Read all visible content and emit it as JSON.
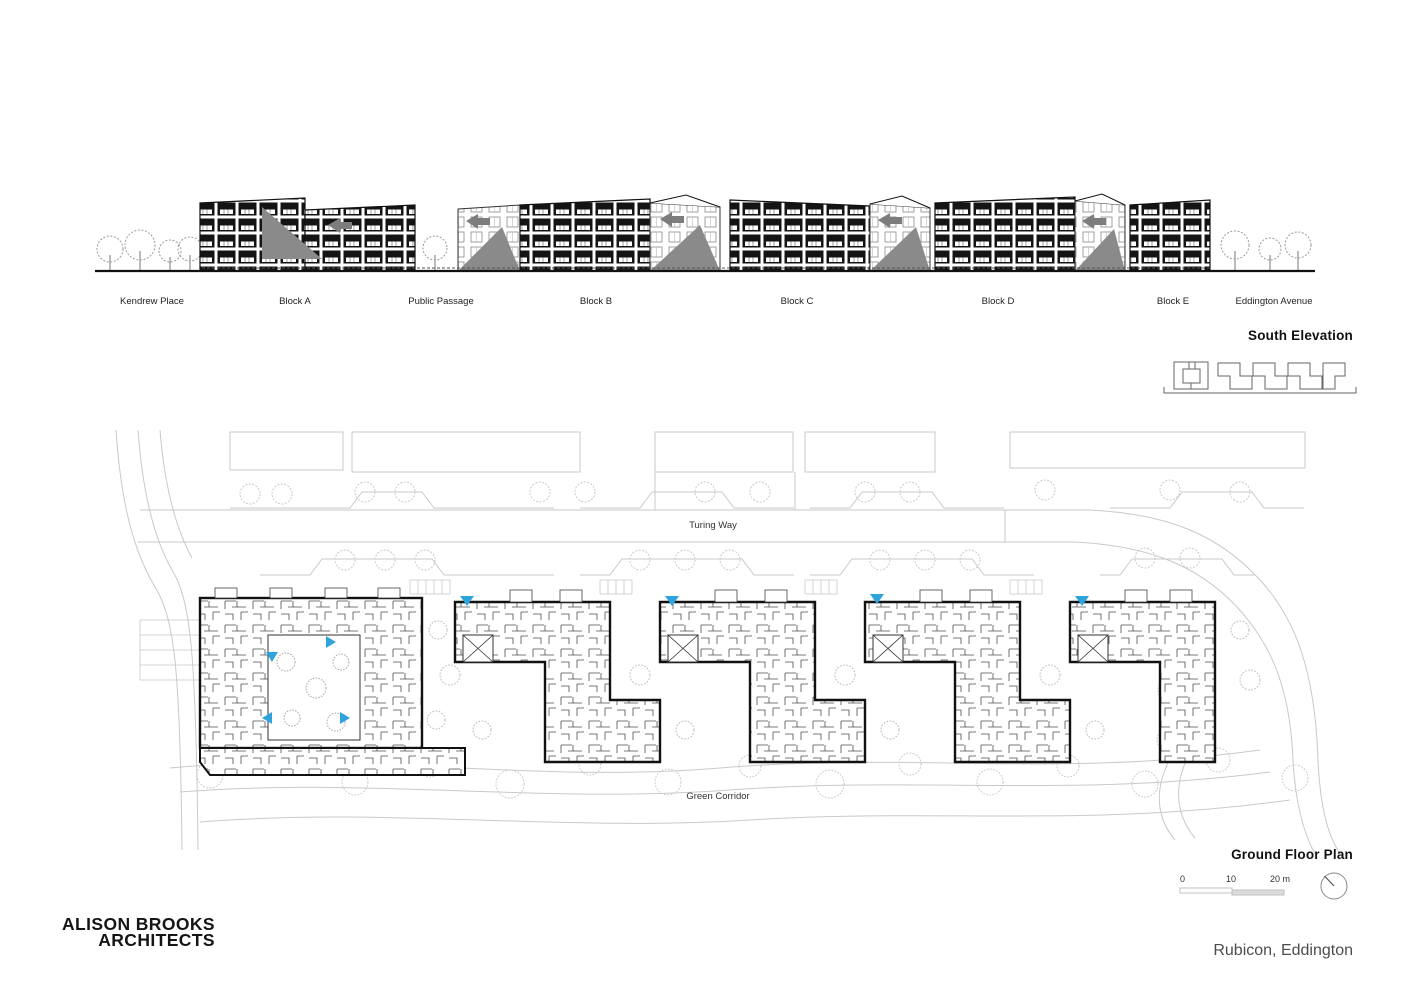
{
  "meta": {
    "firm_line1": "ALISON BROOKS",
    "firm_line2": "ARCHITECTS",
    "project": "Rubicon, Eddington"
  },
  "colors": {
    "accent_blue": "#2fa3dc",
    "line_black": "#1a1a1a",
    "context_grey": "#c9c9c9",
    "gable_grey": "#8a8a8a",
    "title_grey": "#4d4d4d"
  },
  "elevation": {
    "title": "South Elevation",
    "labels": [
      {
        "text": "Kendrew Place"
      },
      {
        "text": "Block A"
      },
      {
        "text": "Public Passage"
      },
      {
        "text": "Block B"
      },
      {
        "text": "Block C"
      },
      {
        "text": "Block D"
      },
      {
        "text": "Block E"
      },
      {
        "text": "Eddington Avenue"
      }
    ]
  },
  "plan": {
    "title": "Ground Floor Plan",
    "street_label": "Turing Way",
    "corridor_label": "Green Corridor",
    "scale": {
      "tick0": "0",
      "tick10": "10",
      "tick20": "20 m"
    },
    "north_icon": "north-arrow-icon",
    "entry_marker_icon": "entry-triangle-icon"
  }
}
